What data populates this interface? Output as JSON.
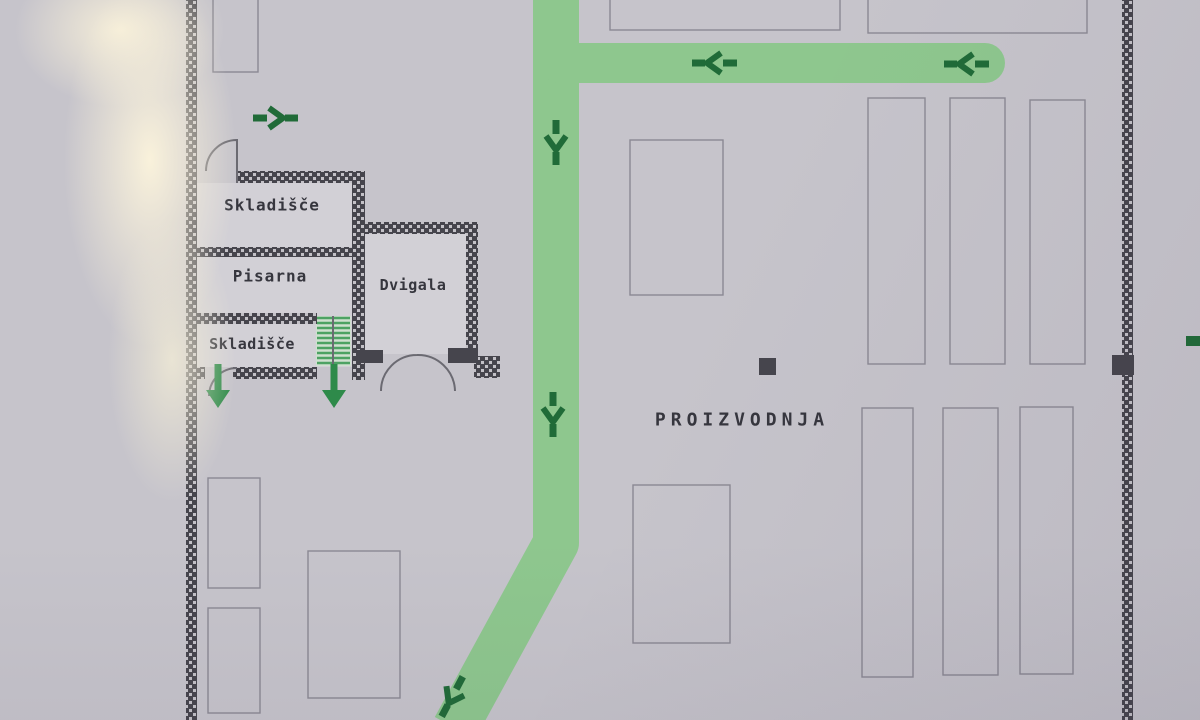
{
  "labels": {
    "skladisce_top": "Skladišče",
    "pisarna": "Pisarna",
    "skladisce_bottom": "Skladišče",
    "dvigala": "Dvigala",
    "proizvodnja": "PROIZVODNJA"
  },
  "icons": {
    "route_arrow_left": "dark green evacuation chevron arrow pointing left",
    "route_arrow_down": "dark green evacuation chevron arrow pointing down",
    "route_arrow_diagonal": "dark green evacuation chevron arrow pointing down-left",
    "exit_arrow_down": "solid green exit arrow pointing down through doorway",
    "stairs": "staircase with green treads",
    "route_marker_dash": "small dark green dash marker on right wall"
  },
  "colors": {
    "paper": "#c6c4cb",
    "room_fill": "#d2d0d6",
    "wall": "#46454d",
    "wall_dash": "#c3c1c7",
    "outline": "#8b8993",
    "route": "#8ec78e",
    "route_arrow": "#206b38",
    "exit_arrow": "#2e8a4a",
    "stair_green": "#4da263",
    "stair_bg": "#cfe0cf",
    "door": "#6b6a72",
    "text": "#36363e"
  }
}
